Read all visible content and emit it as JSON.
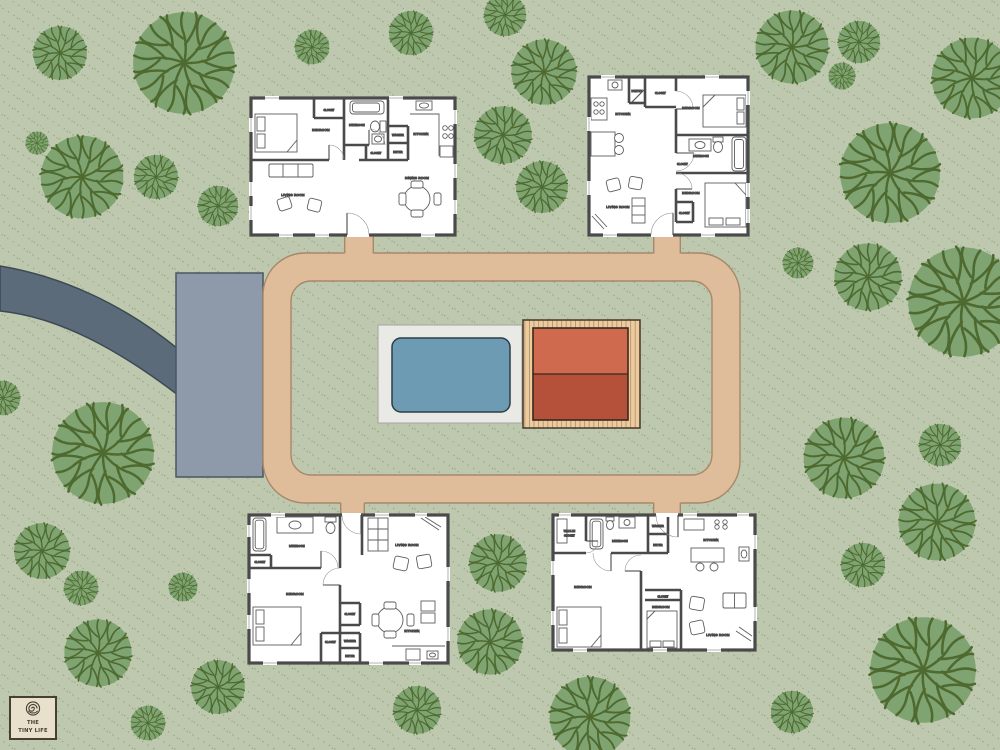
{
  "logo": {
    "line1": "THE",
    "line2": "TINY LIFE"
  },
  "colors": {
    "grass": "#bdc8ae",
    "speckle": "#72894f",
    "tree_fill": "#7fa471",
    "tree_vein": "#4e6a30",
    "road": "#5c6b7a",
    "road_border": "#3d4852",
    "parking": "#8e99a9",
    "parking_border": "#4b5663",
    "path": "#dfbd9b",
    "path_border": "#a8886a",
    "pool_patio": "#e9e9e6",
    "pool_patio_border": "#a5a5a0",
    "pool_water": "#6d9bb3",
    "pool_border": "#2e3d47",
    "deck_wood": "#eeca9f",
    "deck_line": "#a0875f",
    "deck_border": "#443729",
    "pavilion_top": "#cf6a4e",
    "pavilion_bottom": "#b5513a",
    "pavilion_border": "#38291f",
    "house_wall": "#4a4a4a",
    "logo_bg": "#e8e0ca",
    "logo_border": "#454031",
    "logo_text": "#454031"
  },
  "houses": {
    "top_left": {
      "bedroom": "BEDROOM",
      "closet_top": "CLOSET",
      "bathroom": "BATHROOM",
      "closet_hall": "CLOSET",
      "washer": "WASHER",
      "dryer": "DRYER",
      "kitchen": "KITCHEN",
      "living_room": "LIVING ROOM",
      "dining_room": "DINING ROOM"
    },
    "top_right": {
      "kitchen": "KITCHEN",
      "pantry": "PANTRY",
      "closet_top": "CLOSET",
      "bedroom_top": "BEDROOM",
      "bathroom": "BATHROOM",
      "closet_mid": "CLOSET",
      "bedroom_bottom": "BEDROOM",
      "closet_bottom": "CLOSET",
      "living_room": "LIVING ROOM"
    },
    "bottom_left": {
      "bathroom": "BATHROOM",
      "closet_bath": "CLOSET",
      "bedroom": "BEDROOM",
      "closet_mid": "CLOSET",
      "closet_hall": "CLOSET",
      "washer": "WASHER",
      "dryer": "DRYER",
      "living_room": "LIVING ROOM",
      "kitchen": "KITCHEN"
    },
    "bottom_right": {
      "walk_in_line1": "WALK-IN",
      "walk_in_line2": "CLOSET",
      "bathroom": "BATHROOM",
      "washer": "WASHER",
      "dryer": "DRYER",
      "kitchen": "KITCHEN",
      "bedroom_left": "BEDROOM",
      "bedroom_mid": "BEDROOM",
      "closet_mid": "CLOSET",
      "living_room": "LIVING ROOM"
    }
  }
}
